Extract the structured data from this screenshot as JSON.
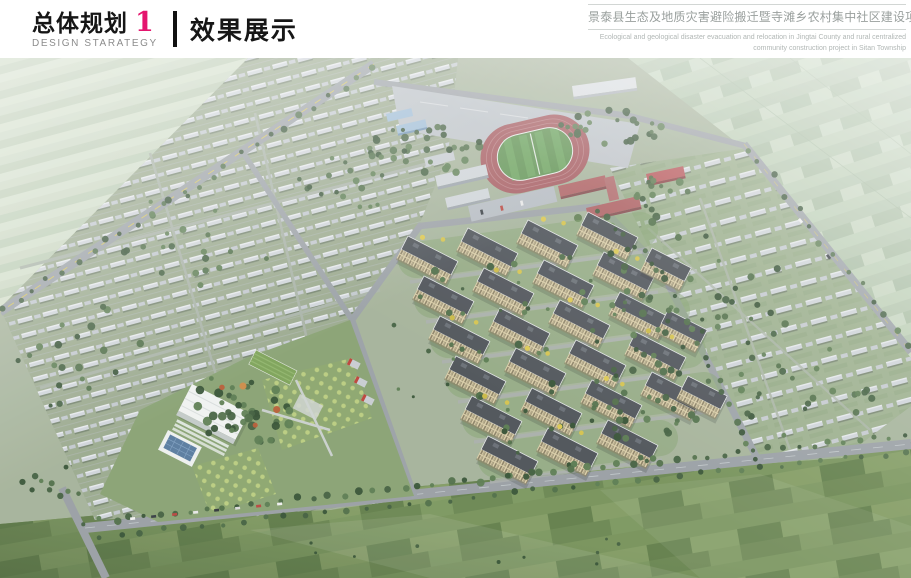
{
  "header": {
    "section_cn": "总体规划",
    "section_number": "1",
    "section_en": "DESIGN STARATEGY",
    "page_title": "效果展示",
    "project_title_cn": "景泰县生态及地质灾害避险搬迁暨寺滩乡农村集中社区建设项目",
    "project_title_en_line1": "Ecological and geological disaster evacuation and relocation in Jingtai County and rural centralized",
    "project_title_en_line2": "community construction project in Sitan Township",
    "accent_color": "#e4156e"
  },
  "rendering": {
    "elements": [
      "village-house-grid-west",
      "village-house-grid-east",
      "farmland-top-left",
      "farmland-top-right",
      "farmland-bottom",
      "school-running-track",
      "school-buildings",
      "apartment-cluster",
      "community-park-orchard",
      "public-buildings",
      "main-roads"
    ],
    "colors": {
      "track_red": "#a4585d",
      "sports_field_green": "#5e9150",
      "farmland_green": "#6b8751",
      "apartment_facade": "#d9cda6",
      "apartment_roof": "#4b5056"
    }
  }
}
